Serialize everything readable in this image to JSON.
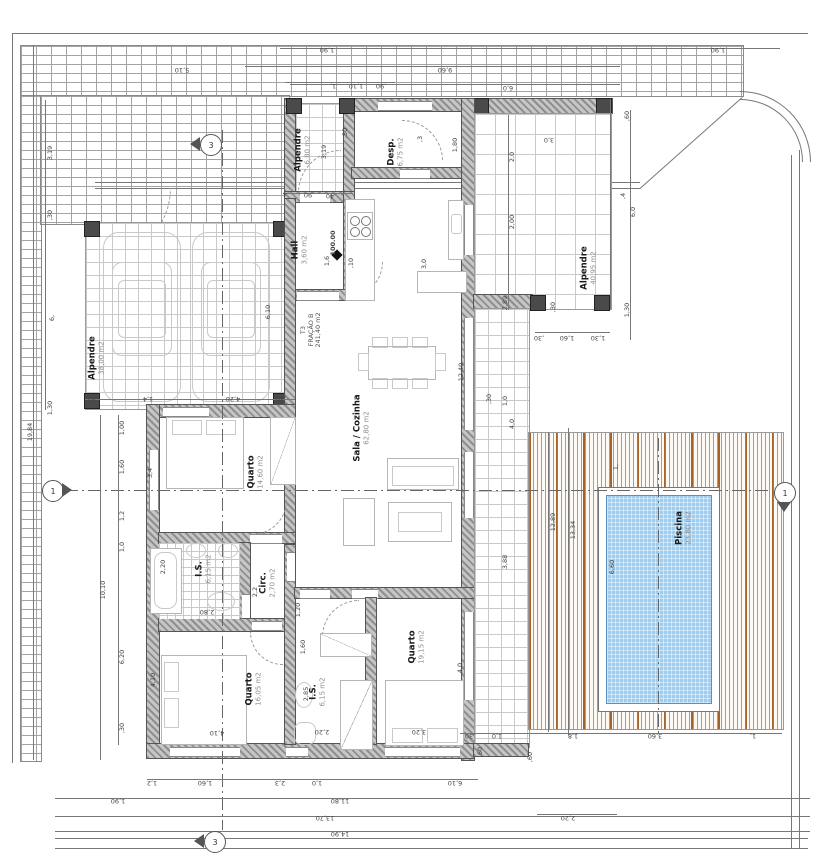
{
  "drawing": {
    "type": "architectural floor plan",
    "unit_label": "m2"
  },
  "colors": {
    "wall_gray": "#8f8f8f",
    "post_gray": "#4a4a4a",
    "deck_wood": "#b5672c",
    "pool_water": "#9fcdf0",
    "tile_line": "#c9c9c9",
    "brick_line": "#a3a3a3",
    "dim_text": "#444444"
  },
  "fraction": {
    "lines": [
      "T3",
      "FRAÇÃO B",
      "241,40 m2"
    ],
    "x": 311,
    "y": 330
  },
  "level": {
    "text": "100.00",
    "x": 333,
    "y": 243,
    "sym_x": 336,
    "sym_y": 254
  },
  "rooms": [
    {
      "name": "Alpendre",
      "area": "6,80 m2",
      "x": 303,
      "y": 150
    },
    {
      "name": "Desp.",
      "area": "6,75 m2",
      "x": 396,
      "y": 152
    },
    {
      "name": "Hall",
      "area": "3,60 m2",
      "x": 300,
      "y": 250
    },
    {
      "name": "Sala / Cozinha",
      "area": "62,80 m2",
      "x": 362,
      "y": 428
    },
    {
      "name": "Alpendre",
      "area": "38,00 m2",
      "x": 97,
      "y": 358
    },
    {
      "name": "Alpendre",
      "area": "40,95 m2",
      "x": 589,
      "y": 268
    },
    {
      "name": "Quarto",
      "area": "14,60 m2",
      "x": 256,
      "y": 472
    },
    {
      "name": "I.S.",
      "area": "6,15 m2",
      "x": 204,
      "y": 569
    },
    {
      "name": "Circ.",
      "area": "2,70 m2",
      "x": 268,
      "y": 583
    },
    {
      "name": "Quarto",
      "area": "16,05 m2",
      "x": 254,
      "y": 689
    },
    {
      "name": "I.S.",
      "area": "6,15 m2",
      "x": 318,
      "y": 692
    },
    {
      "name": "Quarto",
      "area": "19,15 m2",
      "x": 417,
      "y": 647
    },
    {
      "name": "Piscina",
      "area": "23,80 m2",
      "x": 684,
      "y": 528
    }
  ],
  "markers": [
    {
      "n": "1",
      "x": 52,
      "y": 490,
      "tri": "right"
    },
    {
      "n": "1",
      "x": 784,
      "y": 492,
      "tri": "down"
    },
    {
      "n": "3",
      "x": 210,
      "y": 144,
      "tri": "left"
    },
    {
      "n": "3",
      "x": 214,
      "y": 841,
      "tri": "left"
    }
  ],
  "dims": [
    {
      "t": "1,90",
      "x": 327,
      "y": 50,
      "r": 180
    },
    {
      "t": "5,10",
      "x": 182,
      "y": 70,
      "r": 180
    },
    {
      "t": "9,60",
      "x": 445,
      "y": 70,
      "r": 180
    },
    {
      "t": "6,0",
      "x": 508,
      "y": 88,
      "r": 180
    },
    {
      "t": "1,90",
      "x": 718,
      "y": 50,
      "r": 180
    },
    {
      "t": "1,",
      "x": 333,
      "y": 86,
      "r": 180
    },
    {
      "t": "1,10",
      "x": 356,
      "y": 86,
      "r": 180
    },
    {
      "t": ",90",
      "x": 381,
      "y": 86,
      "r": 180
    },
    {
      "t": ",60",
      "x": 627,
      "y": 116,
      "r": -90
    },
    {
      "t": "3,19",
      "x": 50,
      "y": 153,
      "r": -90
    },
    {
      "t": ",30",
      "x": 50,
      "y": 215,
      "r": -90
    },
    {
      "t": "6,",
      "x": 52,
      "y": 318,
      "r": -90
    },
    {
      "t": "1,30",
      "x": 50,
      "y": 408,
      "r": -90
    },
    {
      "t": "19,84",
      "x": 30,
      "y": 432,
      "r": -90
    },
    {
      "t": "1,00",
      "x": 122,
      "y": 428,
      "r": -90
    },
    {
      "t": "1,60",
      "x": 122,
      "y": 467,
      "r": -90
    },
    {
      "t": "1,2",
      "x": 122,
      "y": 516,
      "r": -90
    },
    {
      "t": "1,0",
      "x": 122,
      "y": 547,
      "r": -90
    },
    {
      "t": "10,10",
      "x": 103,
      "y": 590,
      "r": -90
    },
    {
      "t": "6,20",
      "x": 122,
      "y": 657,
      "r": -90
    },
    {
      "t": ",30",
      "x": 122,
      "y": 728,
      "r": -90
    },
    {
      "t": "3,4",
      "x": 150,
      "y": 473,
      "r": -90
    },
    {
      "t": "2,20",
      "x": 163,
      "y": 567,
      "r": -90
    },
    {
      "t": "4,10",
      "x": 153,
      "y": 680,
      "r": -90
    },
    {
      "t": ",30",
      "x": 93,
      "y": 399,
      "r": 180
    },
    {
      "t": "1,4",
      "x": 148,
      "y": 399,
      "r": 180
    },
    {
      "t": "4,20",
      "x": 233,
      "y": 399,
      "r": 180
    },
    {
      "t": ",30",
      "x": 281,
      "y": 399,
      "r": 180
    },
    {
      "t": "6,10",
      "x": 268,
      "y": 312,
      "r": -90
    },
    {
      "t": ",4",
      "x": 286,
      "y": 194,
      "r": 180
    },
    {
      "t": ",90",
      "x": 309,
      "y": 195,
      "r": 180
    },
    {
      "t": ",40",
      "x": 331,
      "y": 196,
      "r": 180
    },
    {
      "t": ",30",
      "x": 345,
      "y": 133,
      "r": -90
    },
    {
      "t": "3,19",
      "x": 324,
      "y": 152,
      "r": -90
    },
    {
      "t": "1,80",
      "x": 455,
      "y": 145,
      "r": -90
    },
    {
      "t": ",3",
      "x": 420,
      "y": 139,
      "r": -90
    },
    {
      "t": "1,6",
      "x": 327,
      "y": 261,
      "r": -90
    },
    {
      "t": ",10",
      "x": 351,
      "y": 263,
      "r": -90
    },
    {
      "t": "3,0",
      "x": 424,
      "y": 264,
      "r": -90
    },
    {
      "t": "12,40",
      "x": 461,
      "y": 372,
      "r": -90
    },
    {
      "t": "3,88",
      "x": 505,
      "y": 562,
      "r": -90
    },
    {
      "t": "4,0",
      "x": 512,
      "y": 424,
      "r": -90
    },
    {
      "t": "1,0",
      "x": 505,
      "y": 401,
      "r": -90
    },
    {
      "t": ",30",
      "x": 489,
      "y": 399,
      "r": -90
    },
    {
      "t": "2,0",
      "x": 512,
      "y": 157,
      "r": -90
    },
    {
      "t": "2,00",
      "x": 512,
      "y": 222,
      "r": -90
    },
    {
      "t": "2,89",
      "x": 505,
      "y": 303,
      "r": -90
    },
    {
      "t": "3,0",
      "x": 549,
      "y": 140,
      "r": 180
    },
    {
      "t": "6,0",
      "x": 633,
      "y": 212,
      "r": -90
    },
    {
      "t": ",4",
      "x": 623,
      "y": 196,
      "r": -90
    },
    {
      "t": "1,30",
      "x": 627,
      "y": 310,
      "r": -90
    },
    {
      "t": ",30",
      "x": 539,
      "y": 338,
      "r": 180
    },
    {
      "t": "1,60",
      "x": 567,
      "y": 338,
      "r": 180
    },
    {
      "t": "1,30",
      "x": 598,
      "y": 338,
      "r": 180
    },
    {
      "t": ",30",
      "x": 553,
      "y": 307,
      "r": -90
    },
    {
      "t": "2,80",
      "x": 207,
      "y": 612,
      "r": 180
    },
    {
      "t": "1,20",
      "x": 298,
      "y": 610,
      "r": -90
    },
    {
      "t": "1,60",
      "x": 303,
      "y": 647,
      "r": -90
    },
    {
      "t": "2,85",
      "x": 306,
      "y": 694,
      "r": -90
    },
    {
      "t": "2,2",
      "x": 255,
      "y": 592,
      "r": -90
    },
    {
      "t": "2,20",
      "x": 322,
      "y": 732,
      "r": 180
    },
    {
      "t": "3,20",
      "x": 419,
      "y": 732,
      "r": 180
    },
    {
      "t": "4,0",
      "x": 460,
      "y": 668,
      "r": -90
    },
    {
      "t": "4,10",
      "x": 217,
      "y": 733,
      "r": 180
    },
    {
      "t": "1,2",
      "x": 152,
      "y": 783,
      "r": 180
    },
    {
      "t": "1,60",
      "x": 205,
      "y": 783,
      "r": 180
    },
    {
      "t": "2,3",
      "x": 280,
      "y": 783,
      "r": 180
    },
    {
      "t": "1,0",
      "x": 317,
      "y": 783,
      "r": 180
    },
    {
      "t": "6,10",
      "x": 455,
      "y": 783,
      "r": 180
    },
    {
      "t": "1,90",
      "x": 118,
      "y": 801,
      "r": 180
    },
    {
      "t": "11,80",
      "x": 340,
      "y": 801,
      "r": 180
    },
    {
      "t": "13,70",
      "x": 325,
      "y": 818,
      "r": 180
    },
    {
      "t": "14,90",
      "x": 340,
      "y": 834,
      "r": 180
    },
    {
      "t": "12,89",
      "x": 553,
      "y": 522,
      "r": -90
    },
    {
      "t": "13,34",
      "x": 573,
      "y": 530,
      "r": -90
    },
    {
      "t": "6,60",
      "x": 612,
      "y": 567,
      "r": -90
    },
    {
      "t": "1,",
      "x": 616,
      "y": 467,
      "r": -90
    },
    {
      "t": ",30",
      "x": 470,
      "y": 736,
      "r": 180
    },
    {
      "t": "1,0",
      "x": 497,
      "y": 736,
      "r": 180
    },
    {
      "t": "1,8",
      "x": 573,
      "y": 736,
      "r": 180
    },
    {
      "t": "3,60",
      "x": 655,
      "y": 736,
      "r": 180
    },
    {
      "t": "1,",
      "x": 753,
      "y": 736,
      "r": 180
    },
    {
      "t": ",60",
      "x": 480,
      "y": 752,
      "r": -90
    },
    {
      "t": ",60",
      "x": 530,
      "y": 757,
      "r": -90
    },
    {
      "t": "2,20",
      "x": 568,
      "y": 818,
      "r": 180
    }
  ]
}
